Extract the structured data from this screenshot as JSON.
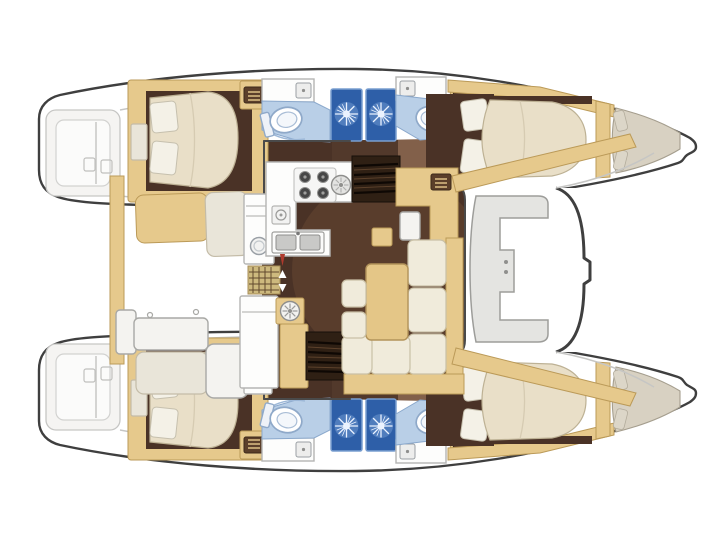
{
  "meta": {
    "title": "Catamaran interior layout floor plan, top-down view, bow pointing right",
    "view": "plan",
    "text_labels": []
  },
  "palette": {
    "hull_outline": "#3f3f3f",
    "deck_line": "#c6c6c4",
    "deck_panel": "#f5f4f2",
    "trim_tan": "#e6c98c",
    "trim_edge": "#bb9a58",
    "floor_dark": "#4a3226",
    "floor_mid": "#82604a",
    "bed_cream": "#e9dfc8",
    "bed_edge": "#bdb194",
    "pillow": "#f4f1e7",
    "bowbed": "#d8d1c2",
    "bath_blue": "#b9cfe7",
    "bath_edge": "#8aa8cc",
    "shower_blue": "#2e5fa8",
    "shower_edge": "#7a9fd0",
    "seat_gray": "#e4e4e1",
    "sofa_cream": "#f0ebdb",
    "table_tan": "#e4c687",
    "step_dark": "#2f2014",
    "grate_tan": "#cdb97e",
    "grate_line": "#61492e",
    "accent_red": "#b03a2e"
  },
  "vessel": {
    "type": "sailing-catamaran",
    "orientation": "bow-right",
    "hulls": [
      {
        "side": "port",
        "position": "top",
        "spaces": [
          {
            "name": "transom-steps"
          },
          {
            "name": "aft-double-cabin",
            "furniture": [
              "island-double-bed",
              "two-pillows",
              "nightstand",
              "hatch-locker"
            ]
          },
          {
            "name": "aft-head",
            "fixtures": [
              "washbasin",
              "toilet",
              "shower-cubicle"
            ]
          },
          {
            "name": "forward-head",
            "fixtures": [
              "washbasin",
              "toilet",
              "shower-cubicle",
              "hatch-locker"
            ]
          },
          {
            "name": "forward-double-cabin",
            "furniture": [
              "island-double-bed",
              "two-pillows"
            ]
          },
          {
            "name": "bow-berth",
            "furniture": [
              "v-berth",
              "two-small-pillows"
            ]
          }
        ]
      },
      {
        "side": "starboard",
        "position": "bottom",
        "spaces": [
          {
            "name": "transom-steps"
          },
          {
            "name": "aft-double-cabin",
            "furniture": [
              "island-double-bed",
              "two-pillows",
              "nightstand",
              "hatch-locker"
            ]
          },
          {
            "name": "aft-head",
            "fixtures": [
              "washbasin",
              "toilet",
              "shower-cubicle"
            ]
          },
          {
            "name": "forward-head",
            "fixtures": [
              "washbasin",
              "toilet",
              "shower-cubicle",
              "hatch-locker"
            ]
          },
          {
            "name": "forward-double-cabin",
            "furniture": [
              "island-double-bed",
              "two-pillows"
            ]
          },
          {
            "name": "bow-berth",
            "furniture": [
              "v-berth",
              "two-small-pillows"
            ]
          }
        ]
      }
    ],
    "bridgedeck": {
      "aft_cockpit": [
        "bench-seat",
        "backrest-cushion",
        "cabinet-with-porthole",
        "floor-grate",
        "cockpit-table",
        "side-bench",
        "aft-bench",
        "aft-cabinet"
      ],
      "galley": [
        "four-burner-stove",
        "round-hob",
        "prep-appliance",
        "double-sink",
        "refrigerator-column",
        "lower-cabinet",
        "mast-pedestal-fan"
      ],
      "saloon": [
        "l-shaped-sofa",
        "dining-table",
        "stool",
        "stool",
        "nav-station",
        "nav-stool",
        "shelf"
      ],
      "stairs": [
        "port-companionway-steps",
        "starboard-companionway-steps"
      ],
      "forward_cockpit": [
        "c-shaped-seat",
        "door-handle-dots",
        "curved-safety-rail",
        "crossbeam-port",
        "crossbeam-starboard"
      ]
    }
  }
}
